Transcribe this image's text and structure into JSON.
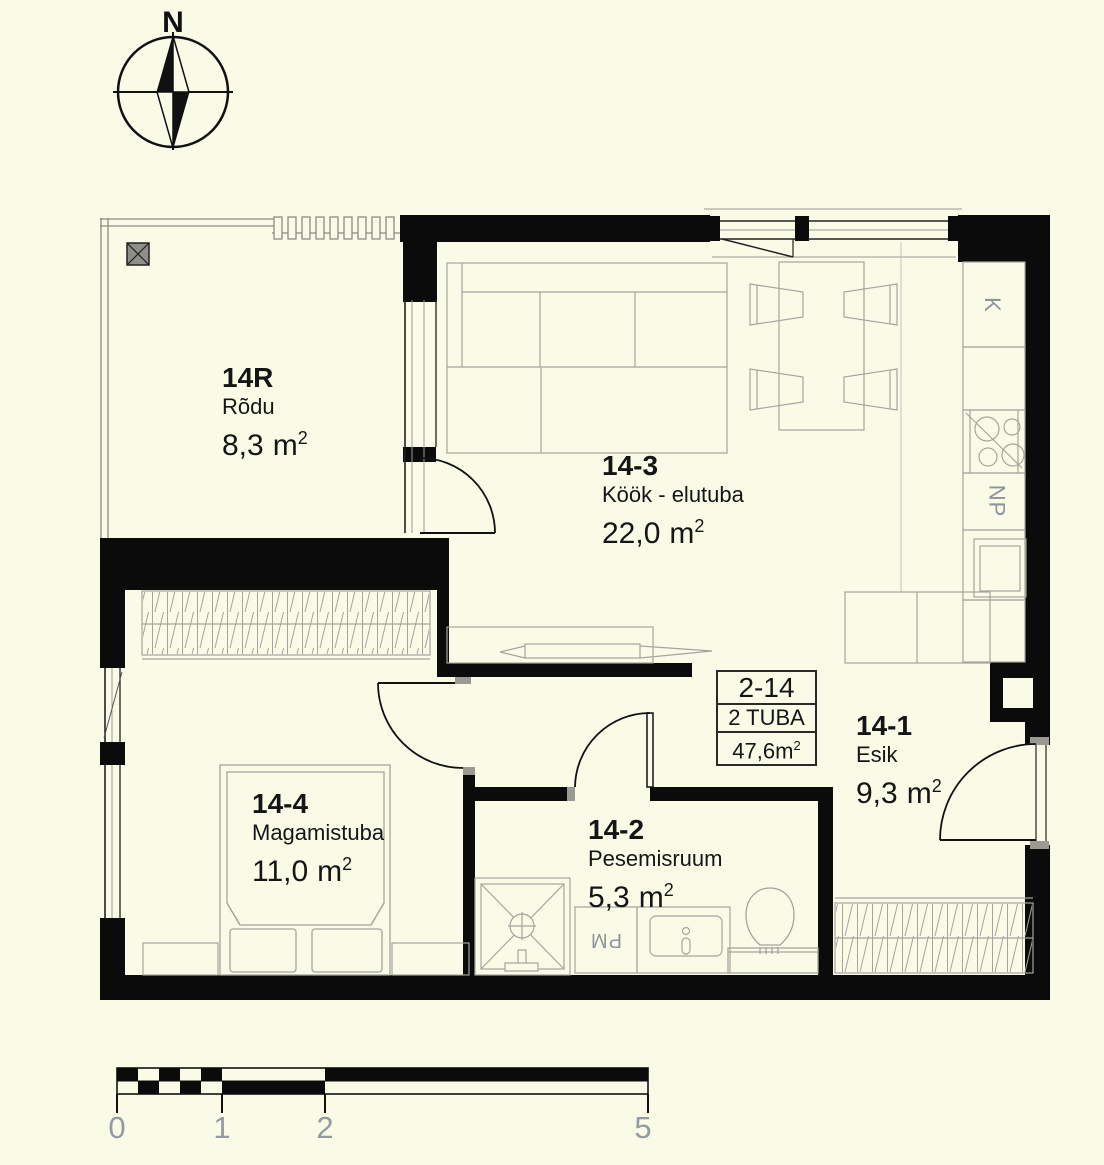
{
  "meta": {
    "sup": "2"
  },
  "compass": {
    "north_label": "N"
  },
  "rooms": [
    {
      "code": "14R",
      "name": "Rõdu",
      "area": "8,3",
      "unit": "m"
    },
    {
      "code": "14-3",
      "name": "Köök - elutuba",
      "area": "22,0",
      "unit": "m"
    },
    {
      "code": "14-1",
      "name": "Esik",
      "area": "9,3",
      "unit": "m"
    },
    {
      "code": "14-2",
      "name": "Pesemisruum",
      "area": "5,3",
      "unit": "m"
    },
    {
      "code": "14-4",
      "name": "Magamistuba",
      "area": "11,0",
      "unit": "m"
    }
  ],
  "info_box": {
    "apartment": "2-14",
    "rooms_line": "2 TUBA",
    "area_value": "47,6m"
  },
  "fixtures": {
    "fridge": "K",
    "np_cabinet": "NP",
    "washing_machine": "PM"
  },
  "scale_bar": {
    "labels": [
      "0",
      "1",
      "2",
      "5"
    ]
  },
  "colors": {
    "background": "#f9fbe7",
    "wall": "#0b0b0b",
    "furniture": "#a5a59d",
    "gray_text": "#8e949b"
  }
}
